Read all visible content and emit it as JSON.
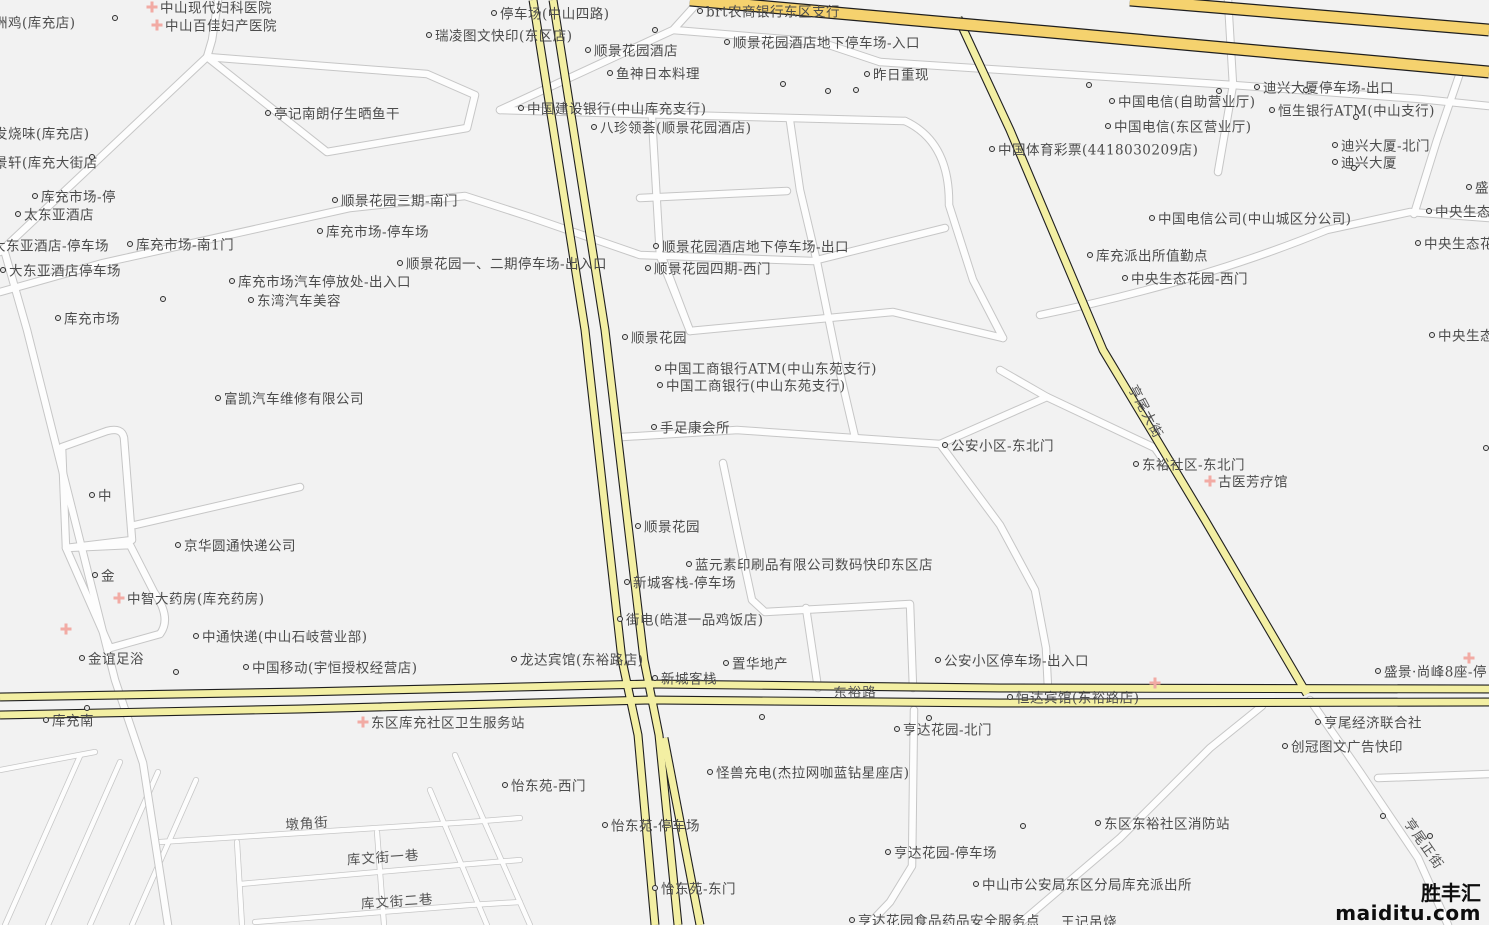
{
  "map": {
    "watermark": {
      "brand": "胜丰汇",
      "site": "maiditu.com"
    },
    "colors": {
      "background": "#f2f2f2",
      "street_fill": "#fdfdfd",
      "street_casing": "#c6c6c6",
      "road_yellow": "#f3efa3",
      "road_yellow_casing": "#1f1f1f",
      "highway_gold": "#f5d26e",
      "highway_casing": "#1f1f1f",
      "label_text": "#4c4c4c",
      "poi_cross": "#f2aba4",
      "watermark_text": "#0d0d0d"
    },
    "road_labels": [
      {
        "text": "东裕路",
        "x": 855,
        "y": 691,
        "rot": -1
      },
      {
        "text": "亨尾大街",
        "x": 1147,
        "y": 411,
        "rot": 62
      },
      {
        "text": "亨尾正街",
        "x": 1425,
        "y": 843,
        "rot": 55
      },
      {
        "text": "墩角街",
        "x": 307,
        "y": 822,
        "rot": -4
      },
      {
        "text": "库文街一巷",
        "x": 383,
        "y": 856,
        "rot": -4
      },
      {
        "text": "库文街二巷",
        "x": 397,
        "y": 900,
        "rot": -4
      }
    ],
    "pois": [
      {
        "label": "洲鸡(库充店)",
        "x": -12,
        "y": 22,
        "marker": "none"
      },
      {
        "label": "中山现代妇科医院",
        "x": 152,
        "y": 7,
        "marker": "cross"
      },
      {
        "label": "中山百佳妇产医院",
        "x": 157,
        "y": 25,
        "marker": "cross"
      },
      {
        "label": "停车场(中山四路)",
        "x": 494,
        "y": 13,
        "marker": "dot"
      },
      {
        "label": "瑞凌图文快印(东区店)",
        "x": 429,
        "y": 35,
        "marker": "dot"
      },
      {
        "label": "brt农商银行东区支行",
        "x": 700,
        "y": 11,
        "marker": "dot"
      },
      {
        "label": "顺景花园酒店",
        "x": 588,
        "y": 50,
        "marker": "dot"
      },
      {
        "label": "顺景花园酒店地下停车场-入口",
        "x": 727,
        "y": 42,
        "marker": "dot"
      },
      {
        "label": "鱼神日本料理",
        "x": 610,
        "y": 73,
        "marker": "dot"
      },
      {
        "label": "昨日重现",
        "x": 867,
        "y": 74,
        "marker": "dot"
      },
      {
        "label": "中国建设银行(中山库充支行)",
        "x": 521,
        "y": 108,
        "marker": "dot"
      },
      {
        "label": "八珍领荟(顺景花园酒店)",
        "x": 594,
        "y": 127,
        "marker": "dot"
      },
      {
        "label": "亭记南朗仔生晒鱼干",
        "x": 268,
        "y": 113,
        "marker": "dot"
      },
      {
        "label": "发烧味(库充店)",
        "x": -12,
        "y": 133,
        "marker": "none"
      },
      {
        "label": "景轩(库充大街店",
        "x": -12,
        "y": 162,
        "marker": "none"
      },
      {
        "label": "库充市场-停",
        "x": 35,
        "y": 196,
        "marker": "dot"
      },
      {
        "label": "太东亚酒店",
        "x": 18,
        "y": 214,
        "marker": "dot"
      },
      {
        "label": "大东亚酒店-停车场",
        "x": -14,
        "y": 245,
        "marker": "none"
      },
      {
        "label": "大东亚酒店停车场",
        "x": 3,
        "y": 270,
        "marker": "dot"
      },
      {
        "label": "库充市场-南1门",
        "x": 130,
        "y": 244,
        "marker": "dot"
      },
      {
        "label": "顺景花园三期-南门",
        "x": 335,
        "y": 200,
        "marker": "dot"
      },
      {
        "label": "库充市场-停车场",
        "x": 320,
        "y": 231,
        "marker": "dot"
      },
      {
        "label": "顺景花园一、二期停车场-出入口",
        "x": 400,
        "y": 263,
        "marker": "dot"
      },
      {
        "label": "库充市场汽车停放处-出入口",
        "x": 232,
        "y": 281,
        "marker": "dot"
      },
      {
        "label": "东湾汽车美容",
        "x": 251,
        "y": 300,
        "marker": "dot"
      },
      {
        "label": "顺景花园酒店地下停车场-出口",
        "x": 656,
        "y": 246,
        "marker": "dot"
      },
      {
        "label": "顺景花园四期-西门",
        "x": 648,
        "y": 268,
        "marker": "dot"
      },
      {
        "label": "库充市场",
        "x": 58,
        "y": 318,
        "marker": "dot"
      },
      {
        "label": "富凯汽车维修有限公司",
        "x": 218,
        "y": 398,
        "marker": "dot"
      },
      {
        "label": "顺景花园",
        "x": 625,
        "y": 337,
        "marker": "dot"
      },
      {
        "label": "中国工商银行ATM(中山东苑支行)",
        "x": 658,
        "y": 368,
        "marker": "dot"
      },
      {
        "label": "中国工商银行(中山东苑支行)",
        "x": 660,
        "y": 385,
        "marker": "dot"
      },
      {
        "label": "手足康会所",
        "x": 654,
        "y": 427,
        "marker": "dot"
      },
      {
        "label": "公安小区-东北门",
        "x": 945,
        "y": 445,
        "marker": "dot"
      },
      {
        "label": "东裕社区-东北门",
        "x": 1136,
        "y": 464,
        "marker": "dot"
      },
      {
        "label": "古医芳疗馆",
        "x": 1210,
        "y": 481,
        "marker": "cross"
      },
      {
        "label": "中",
        "x": 92,
        "y": 495,
        "marker": "dot"
      },
      {
        "label": "京华圆通快递公司",
        "x": 178,
        "y": 545,
        "marker": "dot"
      },
      {
        "label": "顺景花园",
        "x": 638,
        "y": 526,
        "marker": "dot"
      },
      {
        "label": "蓝元素印刷品有限公司数码快印东区店",
        "x": 689,
        "y": 564,
        "marker": "dot"
      },
      {
        "label": "新城客栈-停车场",
        "x": 627,
        "y": 582,
        "marker": "dot"
      },
      {
        "label": "金",
        "x": 95,
        "y": 575,
        "marker": "dot"
      },
      {
        "label": "中智大药房(库充药房)",
        "x": 119,
        "y": 598,
        "marker": "cross"
      },
      {
        "label": "街电(皓湛一品鸡饭店)",
        "x": 620,
        "y": 619,
        "marker": "dot"
      },
      {
        "label": "中通快递(中山石岐营业部)",
        "x": 196,
        "y": 636,
        "marker": "dot"
      },
      {
        "label": "金谊足浴",
        "x": 82,
        "y": 658,
        "marker": "dot"
      },
      {
        "label": "中国移动(宇恒授权经营店)",
        "x": 246,
        "y": 667,
        "marker": "dot"
      },
      {
        "label": "龙达宾馆(东裕路店)",
        "x": 514,
        "y": 659,
        "marker": "dot"
      },
      {
        "label": "置华地产",
        "x": 726,
        "y": 663,
        "marker": "dot"
      },
      {
        "label": "公安小区停车场-出入口",
        "x": 938,
        "y": 660,
        "marker": "dot"
      },
      {
        "label": "新城客栈",
        "x": 655,
        "y": 678,
        "marker": "dot"
      },
      {
        "label": "恒达宾馆(东裕路店)",
        "x": 1010,
        "y": 697,
        "marker": "dot"
      },
      {
        "label": "亨尾经济联合社",
        "x": 1318,
        "y": 722,
        "marker": "dot"
      },
      {
        "label": "创冠图文广告快印",
        "x": 1285,
        "y": 746,
        "marker": "dot"
      },
      {
        "label": "东区库充社区卫生服务站",
        "x": 363,
        "y": 722,
        "marker": "cross"
      },
      {
        "label": "库充南",
        "x": 46,
        "y": 720,
        "marker": "dot"
      },
      {
        "label": "亨达花园-北门",
        "x": 897,
        "y": 729,
        "marker": "dot"
      },
      {
        "label": "亨达花园-停车场",
        "x": 888,
        "y": 852,
        "marker": "dot"
      },
      {
        "label": "怡东苑-西门",
        "x": 505,
        "y": 785,
        "marker": "dot"
      },
      {
        "label": "怪兽充电(杰拉网咖蓝钻星座店)",
        "x": 710,
        "y": 772,
        "marker": "dot"
      },
      {
        "label": "怡东苑-停车场",
        "x": 605,
        "y": 825,
        "marker": "dot"
      },
      {
        "label": "怡东苑-东门",
        "x": 655,
        "y": 888,
        "marker": "dot"
      },
      {
        "label": "东区东裕社区消防站",
        "x": 1098,
        "y": 823,
        "marker": "dot"
      },
      {
        "label": "中山市公安局东区分局库充派出所",
        "x": 976,
        "y": 884,
        "marker": "dot"
      },
      {
        "label": "亨达花园食品药品安全服务点",
        "x": 852,
        "y": 920,
        "marker": "dot"
      },
      {
        "label": "王记吊烧",
        "x": 1055,
        "y": 921,
        "marker": "none"
      },
      {
        "label": "盛景·尚峰8座-停",
        "x": 1378,
        "y": 671,
        "marker": "dot"
      },
      {
        "label": "迪兴大厦停车场-出口",
        "x": 1257,
        "y": 87,
        "marker": "dot"
      },
      {
        "label": "恒生银行ATM(中山支行)",
        "x": 1272,
        "y": 110,
        "marker": "dot"
      },
      {
        "label": "中国电信(自助营业厅)",
        "x": 1112,
        "y": 101,
        "marker": "dot"
      },
      {
        "label": "中国电信(东区营业厅)",
        "x": 1108,
        "y": 126,
        "marker": "dot"
      },
      {
        "label": "中国体育彩票(4418030209店)",
        "x": 992,
        "y": 149,
        "marker": "dot"
      },
      {
        "label": "迪兴大厦-北门",
        "x": 1335,
        "y": 145,
        "marker": "dot"
      },
      {
        "label": "迪兴大厦",
        "x": 1335,
        "y": 162,
        "marker": "dot"
      },
      {
        "label": "中国电信公司(中山城区分公司)",
        "x": 1152,
        "y": 218,
        "marker": "dot"
      },
      {
        "label": "库充派出所值勤点",
        "x": 1090,
        "y": 255,
        "marker": "dot"
      },
      {
        "label": "中央生态花园-西门",
        "x": 1125,
        "y": 278,
        "marker": "dot"
      },
      {
        "label": "盛景",
        "x": 1469,
        "y": 187,
        "marker": "dot"
      },
      {
        "label": "中央生态",
        "x": 1429,
        "y": 211,
        "marker": "dot"
      },
      {
        "label": "中央生态花园",
        "x": 1418,
        "y": 243,
        "marker": "dot"
      },
      {
        "label": "中央生态",
        "x": 1432,
        "y": 335,
        "marker": "dot"
      }
    ],
    "dots": [
      [
        115,
        18
      ],
      [
        655,
        30
      ],
      [
        783,
        84
      ],
      [
        828,
        91
      ],
      [
        856,
        90
      ],
      [
        1089,
        85
      ],
      [
        1219,
        91
      ],
      [
        1306,
        90
      ],
      [
        1356,
        117
      ],
      [
        1354,
        168
      ],
      [
        92,
        157
      ],
      [
        163,
        299
      ],
      [
        87,
        708
      ],
      [
        176,
        672
      ],
      [
        762,
        717
      ],
      [
        929,
        718
      ],
      [
        1023,
        826
      ],
      [
        1383,
        816
      ],
      [
        1430,
        836
      ],
      [
        1486,
        448
      ]
    ],
    "crosses": [
      [
        66,
        629
      ],
      [
        1155,
        683
      ],
      [
        1469,
        658
      ]
    ]
  }
}
